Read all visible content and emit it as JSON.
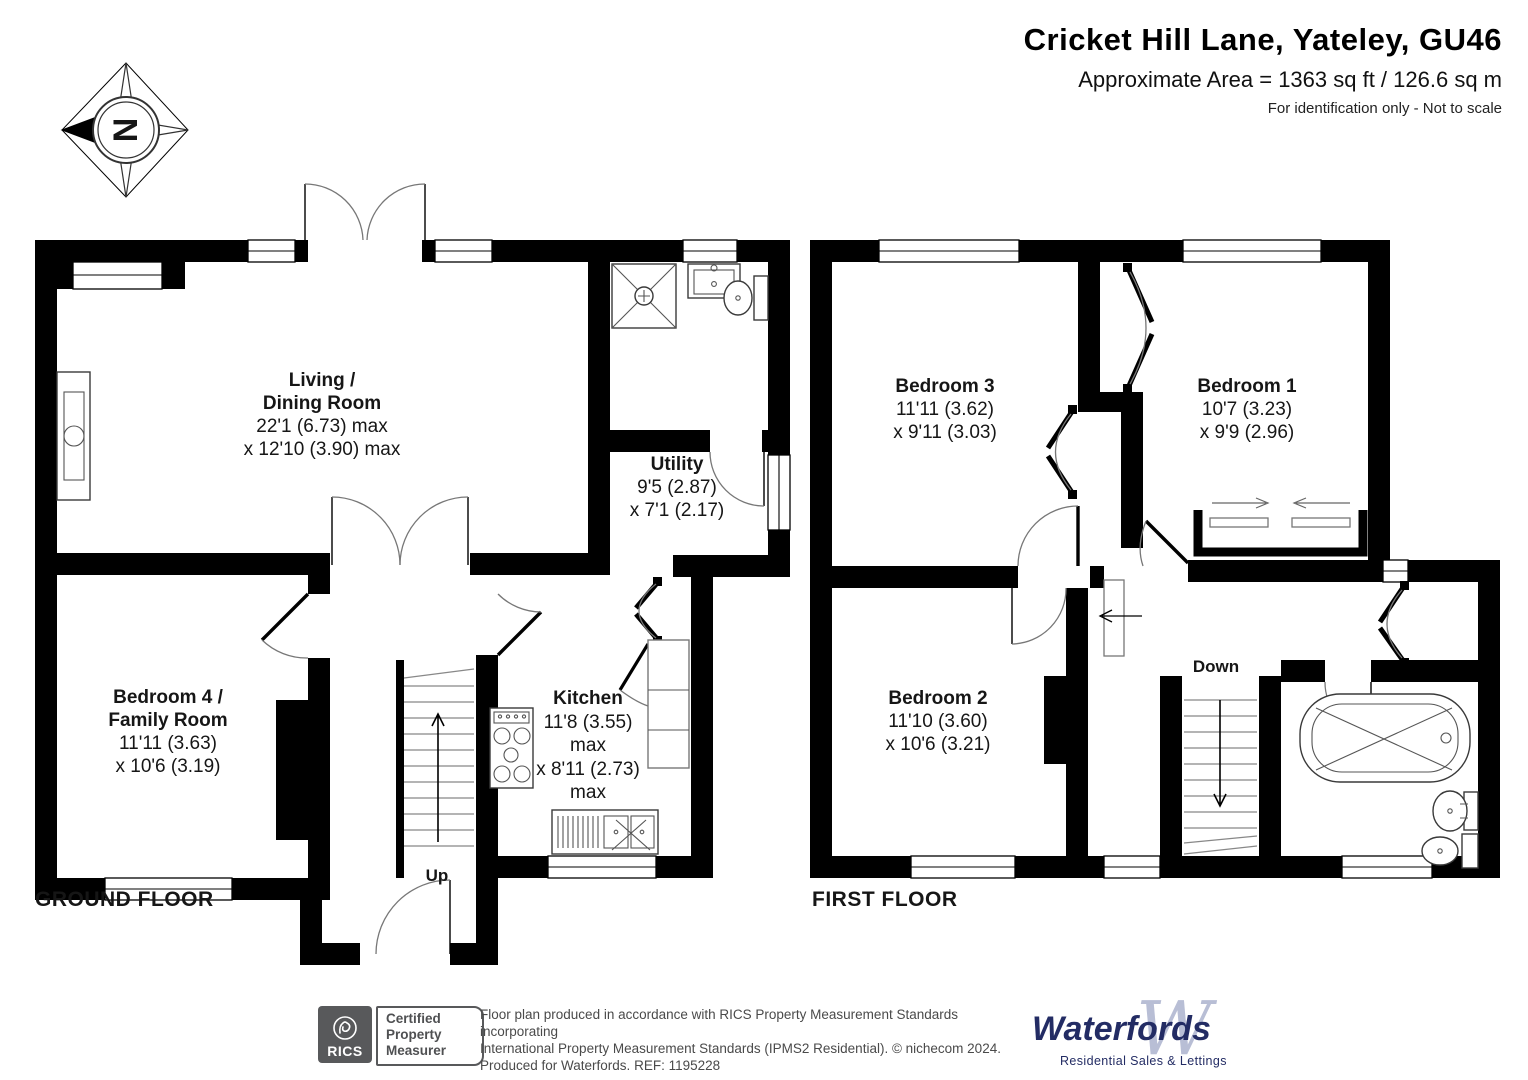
{
  "header": {
    "title": "Cricket Hill Lane, Yateley, GU46",
    "area": "Approximate Area = 1363 sq ft / 126.6 sq m",
    "note": "For identification only - Not to scale"
  },
  "compass": {
    "letter": "N"
  },
  "floors": {
    "ground": {
      "label": "GROUND FLOOR",
      "stairs_label": "Up",
      "rooms": {
        "living": [
          "Living /",
          "Dining Room",
          "22'1 (6.73) max",
          "x 12'10 (3.90) max"
        ],
        "utility": [
          "Utility",
          "9'5 (2.87)",
          "x 7'1 (2.17)"
        ],
        "bedroom4": [
          "Bedroom 4 /",
          "Family Room",
          "11'11 (3.63)",
          "x 10'6 (3.19)"
        ],
        "kitchen": [
          "Kitchen",
          "11'8 (3.55)",
          "max",
          "x 8'11 (2.73)",
          "max"
        ]
      }
    },
    "first": {
      "label": "FIRST FLOOR",
      "stairs_label": "Down",
      "rooms": {
        "bedroom3": [
          "Bedroom 3",
          "11'11 (3.62)",
          "x 9'11 (3.03)"
        ],
        "bedroom1": [
          "Bedroom 1",
          "10'7 (3.23)",
          "x 9'9 (2.96)"
        ],
        "bedroom2": [
          "Bedroom 2",
          "11'10 (3.60)",
          "x 10'6 (3.21)"
        ]
      }
    }
  },
  "footer": {
    "rics_brand": "RICS",
    "certification": [
      "Certified",
      "Property",
      "Measurer"
    ],
    "disclaimer": [
      "Floor plan produced in accordance with RICS Property Measurement Standards incorporating",
      "International Property Measurement Standards (IPMS2 Residential).   © nichecom 2024.",
      "Produced for Waterfords.   REF: 1195228"
    ],
    "waterfords_name": "Waterfords",
    "waterfords_monogram": "W",
    "waterfords_tagline": "Residential Sales & Lettings"
  },
  "colors": {
    "walls": "#000000",
    "navy": "#232c64",
    "logo_light_blue": "#b8bed5",
    "rics_gray": "#58595b"
  }
}
